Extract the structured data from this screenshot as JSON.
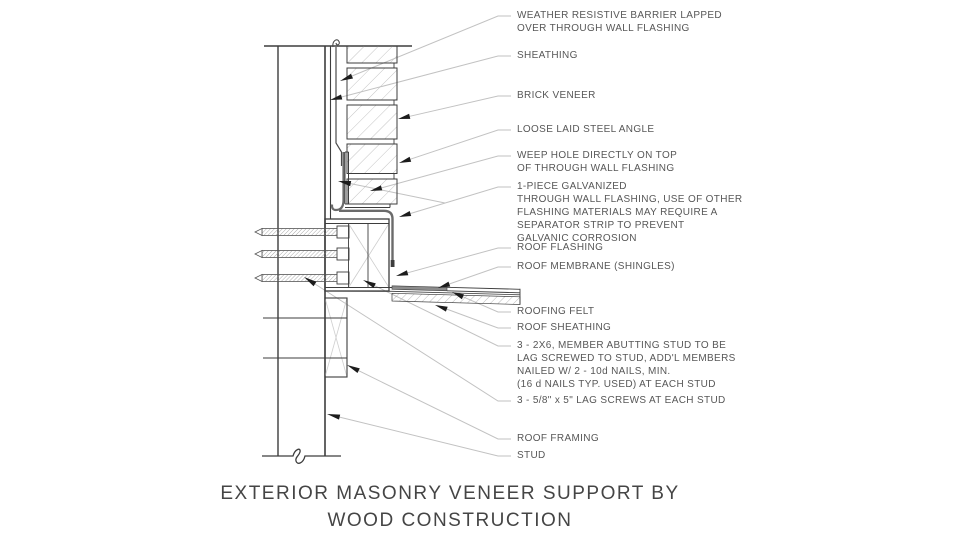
{
  "title": {
    "text": "EXTERIOR MASONRY VENEER SUPPORT BY\nWOOD CONSTRUCTION"
  },
  "annotations": [
    {
      "id": "weather-resistive-barrier",
      "text": "WEATHER RESISTIVE BARRIER LAPPED\nOVER THROUGH WALL FLASHING"
    },
    {
      "id": "sheathing",
      "text": "SHEATHING"
    },
    {
      "id": "brick-veneer",
      "text": "BRICK VENEER"
    },
    {
      "id": "loose-laid-steel-angle",
      "text": "LOOSE LAID STEEL ANGLE"
    },
    {
      "id": "weep-hole",
      "text": "WEEP HOLE DIRECTLY ON TOP\nOF THROUGH WALL FLASHING"
    },
    {
      "id": "through-wall-flashing",
      "text": "1-PIECE GALVANIZED\nTHROUGH WALL FLASHING, USE OF OTHER\nFLASHING MATERIALS MAY REQUIRE A\nSEPARATOR STRIP TO PREVENT\nGALVANIC CORROSION"
    },
    {
      "id": "roof-flashing",
      "text": "ROOF FLASHING"
    },
    {
      "id": "roof-membrane",
      "text": "ROOF MEMBRANE (SHINGLES)"
    },
    {
      "id": "roofing-felt",
      "text": "ROOFING FELT"
    },
    {
      "id": "roof-sheathing",
      "text": "ROOF SHEATHING"
    },
    {
      "id": "2x6-members",
      "text": "3 - 2X6, MEMBER ABUTTING STUD TO BE\nLAG SCREWED TO STUD, ADD'L MEMBERS\nNAILED W/ 2 - 10d NAILS, MIN.\n(16 d NAILS TYP. USED) AT EACH STUD"
    },
    {
      "id": "lag-screws",
      "text": "3 - 5/8\" x 5\" LAG SCREWS AT EACH STUD"
    },
    {
      "id": "roof-framing",
      "text": "ROOF FRAMING"
    },
    {
      "id": "stud",
      "text": "STUD"
    }
  ],
  "colors": {
    "line": "#3d3d3d",
    "leader": "#c2c2c2",
    "arrow": "#1c1c1c",
    "flashing": "#6b6b6b",
    "membrane_fill": "#8c8c8c",
    "text": "#575757"
  }
}
